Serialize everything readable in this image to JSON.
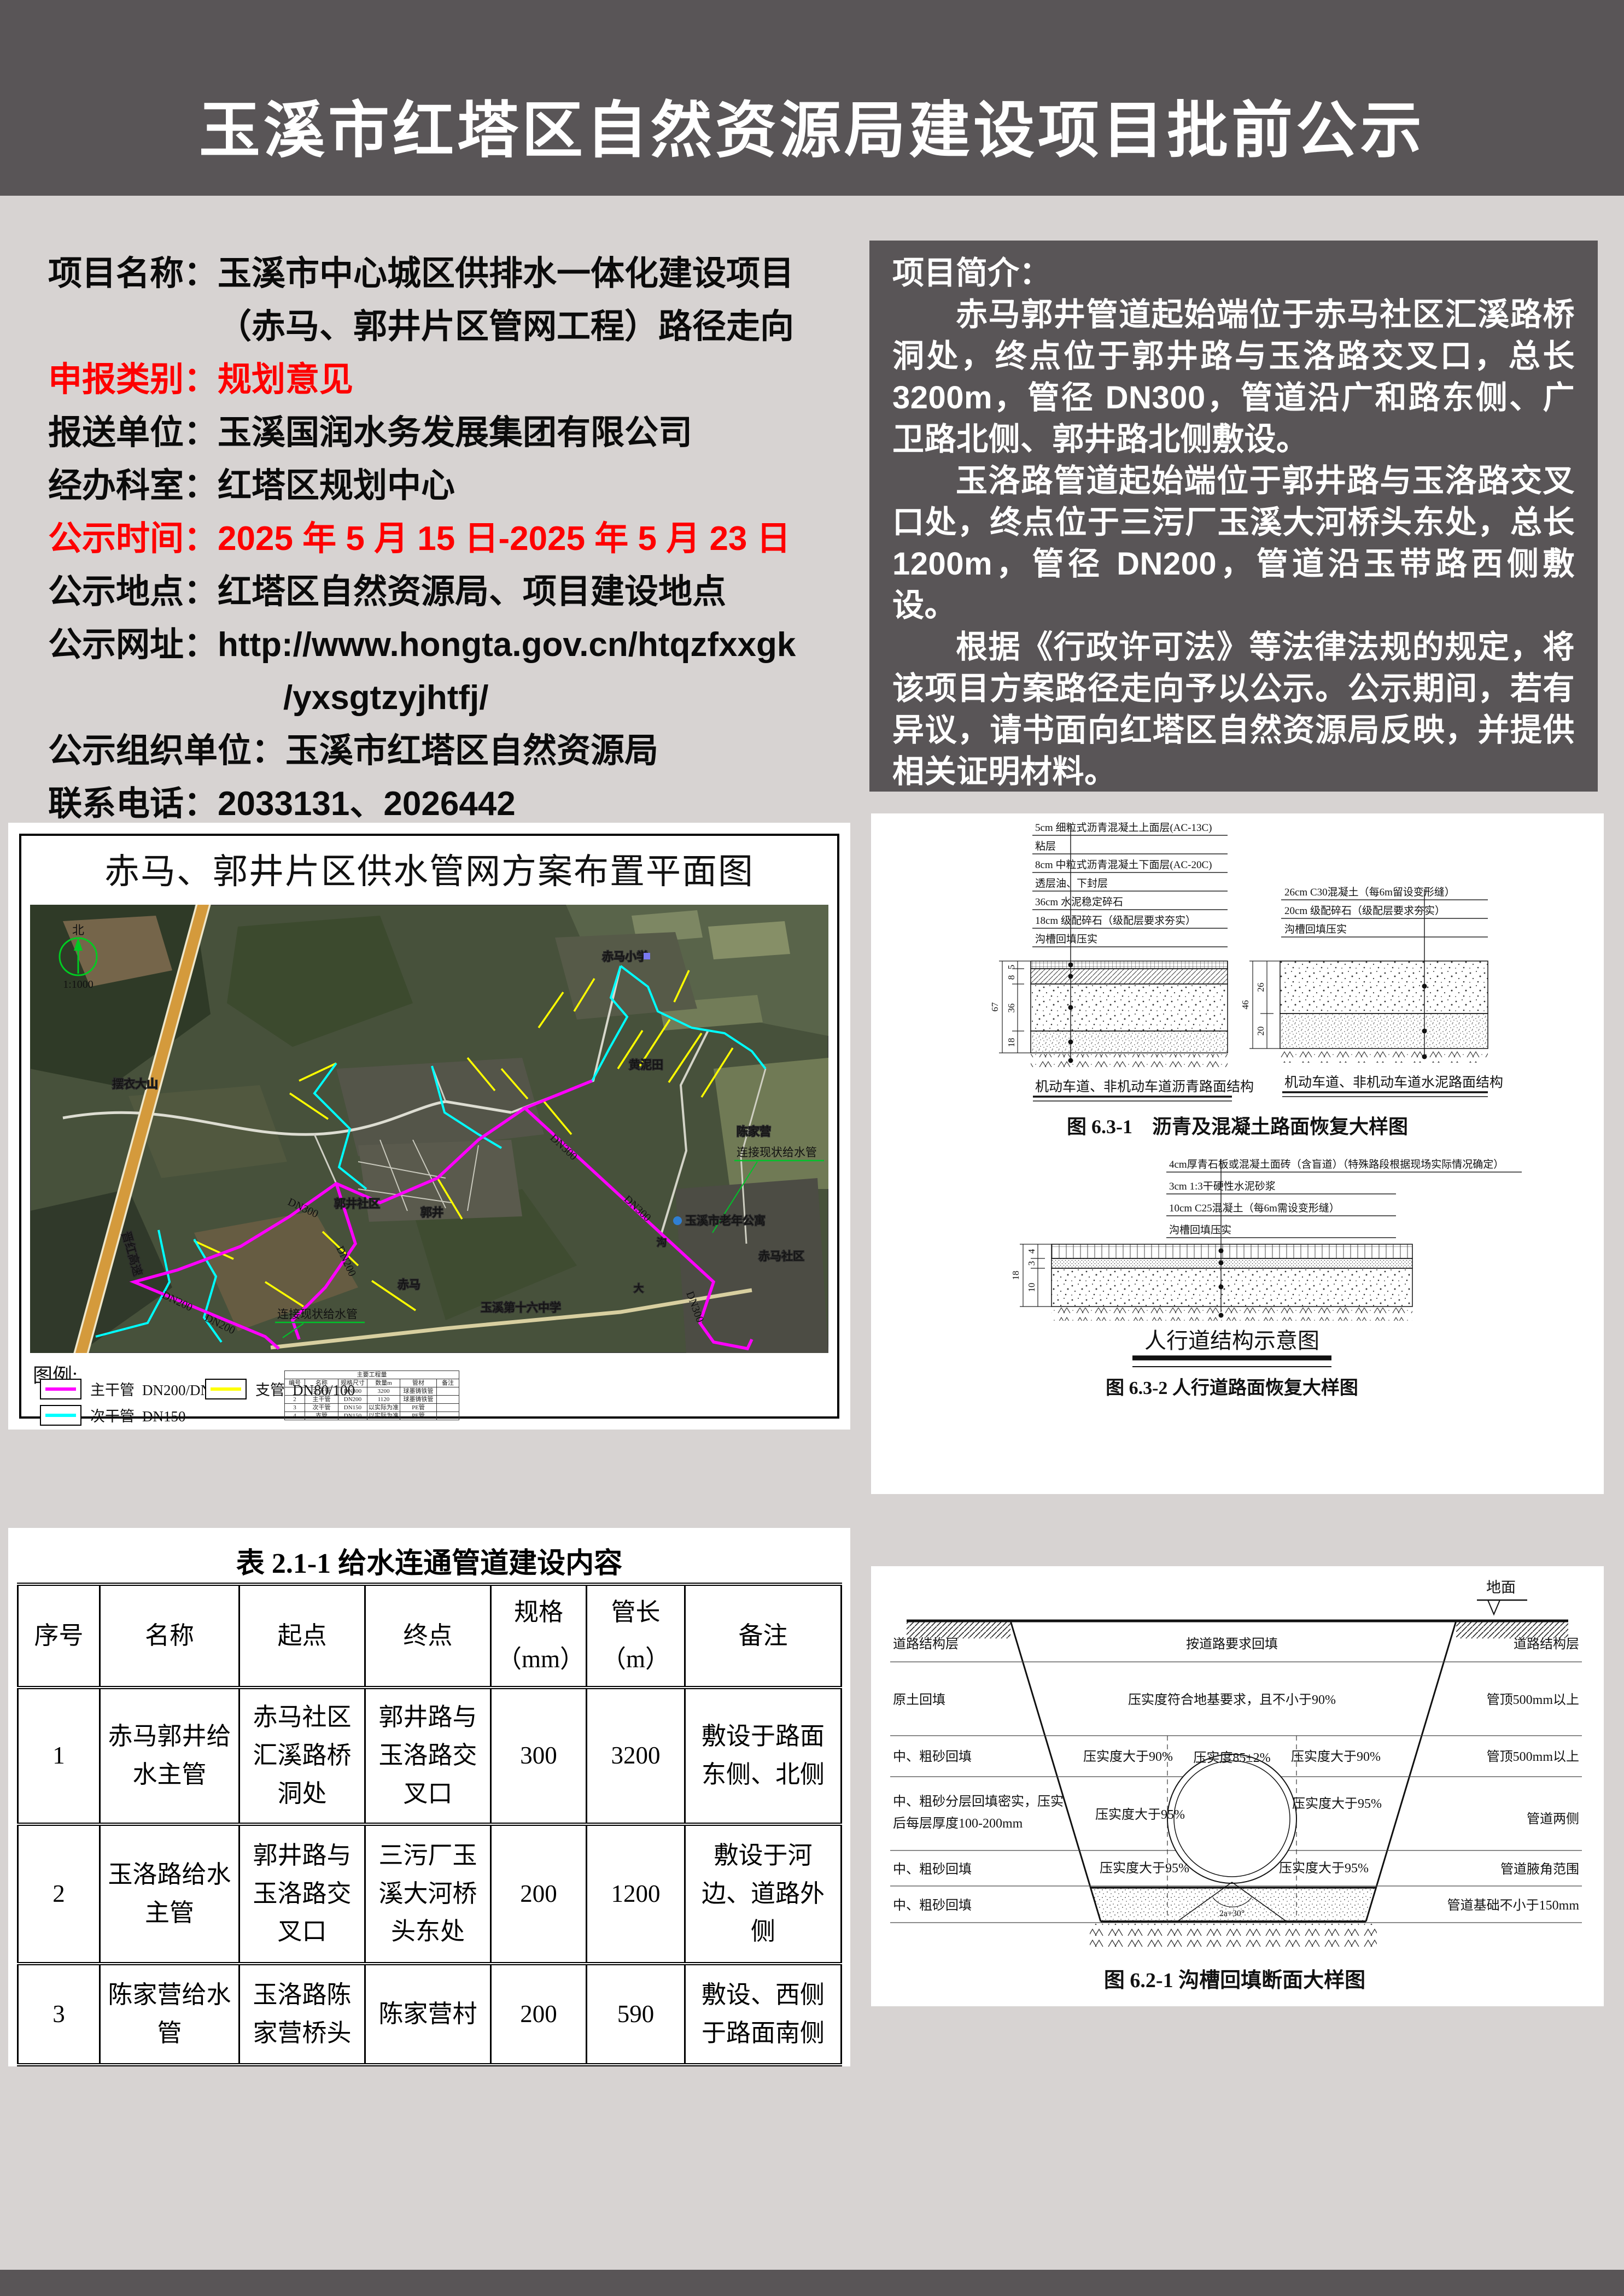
{
  "page": {
    "title": "玉溪市红塔区自然资源局建设项目批前公示",
    "colors": {
      "band": "#595557",
      "page_bg": "#d7d3d2",
      "red": "#fe0000",
      "magenta": "#ff00ff",
      "cyan": "#00ffff",
      "yellow": "#ffff00",
      "green": "#00c32a"
    }
  },
  "info": {
    "lines": [
      {
        "text": "项目名称：玉溪市中心城区供排水一体化建设项目"
      },
      {
        "text": "（赤马、郭井片区管网工程）路径走向"
      },
      {
        "text": "申报类别：规划意见"
      },
      {
        "text": "报送单位：玉溪国润水务发展集团有限公司"
      },
      {
        "text": "经办科室：红塔区规划中心"
      },
      {
        "text": "公示时间：2025 年 5 月 15 日-2025 年 5 月 23 日"
      },
      {
        "text": "公示地点：红塔区自然资源局、项目建设地点"
      },
      {
        "text": "公示网址：http://www.hongta.gov.cn/htqzfxxgk"
      },
      {
        "text": "/yxsgtzyjhtfj/"
      },
      {
        "text": "公示组织单位：玉溪市红塔区自然资源局"
      },
      {
        "text": "联系电话：2033131、2026442"
      }
    ]
  },
  "intro": {
    "heading": "项目简介：",
    "paragraphs": [
      "赤马郭井管道起始端位于赤马社区汇溪路桥洞处，终点位于郭井路与玉洛路交叉口，总长 3200m，管径 DN300，管道沿广和路东侧、广卫路北侧、郭井路北侧敷设。",
      "玉洛路管道起始端位于郭井路与玉洛路交叉口处，终点位于三污厂玉溪大河桥头东处，总长 1200m，管径 DN200，管道沿玉带路西侧敷设。",
      "根据《行政许可法》等法律法规的规定，将该项目方案路径走向予以公示。公示期间，若有异议，请书面向红塔区自然资源局反映，并提供相关证明材料。"
    ]
  },
  "map": {
    "title": "赤马、郭井片区供水管网方案布置平面图",
    "legend_title": "图例:",
    "legend": [
      {
        "name": "主干管",
        "spec": "DN200/DN300",
        "color": "#ff00ff"
      },
      {
        "name": "支管",
        "spec": "DN80/100",
        "color": "#ffff00"
      },
      {
        "name": "次干管",
        "spec": "DN150",
        "color": "#00ffff"
      }
    ],
    "compass": "北",
    "scale": "1:1000",
    "dn300": "DN300",
    "dn200": "DN200",
    "green_label": "连接现状给水管",
    "places": [
      "摆衣大山",
      "赤马小学",
      "黄泥田",
      "陈家营",
      "玉溪市老年公寓",
      "赤马社区",
      "郭井社区",
      "郭井",
      "玉溪第十六中学",
      "赤马",
      "晋红高速",
      "沟",
      "大"
    ],
    "qty": {
      "title": "主要工程量",
      "headers": [
        "编号",
        "名称",
        "规格尺寸",
        "数量m",
        "管材",
        "备注"
      ],
      "rows": [
        [
          "1",
          "主干管",
          "DN300",
          "3200",
          "球墨铸铁管",
          ""
        ],
        [
          "2",
          "主干管",
          "DN200",
          "1120",
          "球墨铸铁管",
          ""
        ],
        [
          "3",
          "次干管",
          "DN150",
          "以实际为准",
          "PE管",
          ""
        ],
        [
          "4",
          "支管",
          "DN150",
          "以实际为准",
          "PE管",
          ""
        ]
      ]
    }
  },
  "btable": {
    "title": "表 2.1-1 给水连通管道建设内容",
    "headers": [
      "序号",
      "名称",
      "起点",
      "终点",
      "规格\n（mm）",
      "管长\n（m）",
      "备注"
    ],
    "rows": [
      [
        "1",
        "赤马郭井给水主管",
        "赤马社区汇溪路桥洞处",
        "郭井路与玉洛路交叉口",
        "300",
        "3200",
        "敷设于路面东侧、北侧"
      ],
      [
        "2",
        "玉洛路给水主管",
        "郭井路与玉洛路交叉口",
        "三污厂玉溪大河桥头东处",
        "200",
        "1200",
        "敷设于河边、道路外侧"
      ],
      [
        "3",
        "陈家营给水管",
        "玉洛路陈家营桥头",
        "陈家营村",
        "200",
        "590",
        "敷设、西侧于路面南侧"
      ]
    ]
  },
  "fig631": {
    "left_callouts": [
      "5cm 细粒式沥青混凝土上面层(AC-13C)",
      "粘层",
      "8cm 中粒式沥青混凝土下面层(AC-20C)",
      "透层油、下封层",
      "36cm  水泥稳定碎石",
      "18cm  级配碎石（级配层要求夯实）",
      "沟槽回填压实"
    ],
    "right_callouts": [
      "26cm  C30混凝土（每6m留设变形缝）",
      "20cm  级配碎石（级配层要求夯实）",
      "沟槽回填压实"
    ],
    "left_dims": [
      "5",
      "8",
      "36",
      "18"
    ],
    "left_total": "67",
    "right_dims": [
      "26",
      "20"
    ],
    "right_total": "46",
    "left_caption": "机动车道、非机动车道沥青路面结构",
    "right_caption": "机动车道、非机动车道水泥路面结构",
    "caption": "图 6.3-1　沥青及混凝土路面恢复大样图"
  },
  "fig632": {
    "callouts": [
      "4cm厚青石板或混凝土面砖（含盲道）（特殊路段根据现场实际情况确定）",
      "3cm  1:3干硬性水泥砂浆",
      "10cm  C25混凝土（每6m需设变形缝）",
      "沟槽回填压实"
    ],
    "dims": [
      "4",
      "3",
      "10"
    ],
    "total": "18",
    "subtitle": "人行道结构示意图",
    "caption": "图 6.3-2  人行道路面恢复大样图"
  },
  "fig621": {
    "ground": "地面",
    "left_labels": [
      "道路结构层",
      "原土回填",
      "中、粗砂回填",
      "中、粗砂分层回填密实，压实",
      "后每层厚度100-200mm",
      "中、粗砂回填",
      "中、粗砂回填"
    ],
    "center": {
      "r1": "按道路要求回填",
      "r2": "压实度符合地基要求，且不小于90%",
      "r3l": "压实度大于90%",
      "r3m": "压实度85±2%",
      "r3r": "压实度大于90%",
      "r4l": "压实度大于95%",
      "r4r": "压实度大于95%",
      "r5l": "压实度大于95%",
      "r5r": "压实度大于95%"
    },
    "right_labels": [
      "道路结构层",
      "管顶500mm以上",
      "管顶500mm以上",
      "管道两侧",
      "管道腋角范围",
      "管道基础不小于150mm"
    ],
    "angle": "2a+30°",
    "caption": "图 6.2-1 沟槽回填断面大样图"
  }
}
